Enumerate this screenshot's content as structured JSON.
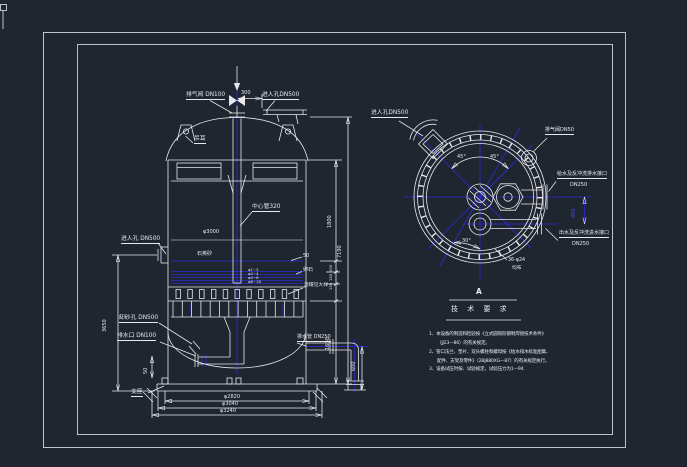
{
  "window": {
    "background": "#20262f"
  },
  "colors": {
    "frame_green": "#00ff00",
    "line_white": "#e8e8ec",
    "centerline_blue": "#2b2bdd"
  },
  "front_view": {
    "labels": {
      "vent_valve": "排气阀 DN100",
      "top_manhole": "进人孔DN500",
      "lifting_lug": "吊耳",
      "center_pipe": "中心管320",
      "shell_diameter": "φ3000",
      "side_manhole": "进人孔 DN500",
      "quartz_sand": "石英砂",
      "pebble": "卵石",
      "filter_cap": "滤帽见大样",
      "lower_manhole": "卸砂孔 DN500",
      "drain": "排水口 DN100",
      "support": "支座",
      "outlet_pipe": "排水管 DN250"
    },
    "layer_marks": [
      "φ1~2",
      "φ2~4",
      "φ4~8",
      "φ8~16"
    ],
    "dims": {
      "top_offset": "300",
      "freeboard": "50",
      "upper_right": "1800",
      "layer_dims": [
        "100",
        "150",
        "150"
      ],
      "lower_right": "1600",
      "overall": "7190",
      "skirt": "600",
      "left_height": "3650",
      "left_small": "50",
      "bottom_d1": "φ2820",
      "bottom_d2": "φ3040",
      "bottom_d3": "φ3240"
    }
  },
  "top_view": {
    "view_label": "A",
    "labels": {
      "manhole": "进人孔DN500",
      "vent": "排气阀DN50",
      "inlet_line1": "给水及反冲洗排水接口",
      "inlet_line2": "DN250",
      "outlet_line1": "出水及反冲洗进水接口",
      "outlet_line2": "DN250",
      "bolt_note1": "36-φ24",
      "bolt_note2": "均布",
      "angle_a": "45°",
      "angle_b": "45°",
      "angle_c": "30°",
      "offset": "450"
    }
  },
  "notes": {
    "title": "技 术 要 求",
    "lines": [
      "1、本设备的制造和检验按《立式圆筒形钢制焊接技术条件》",
      "（JJ23—86）的有关规定。",
      "2、管口法兰、垫片、双头螺柱和螺母按《给水排水标准图集、",
      "配件、支架及零件》（2BJ880XG—87）的有关规定执行。",
      "3、设备试压时按、试验规定，试验压力为1—94."
    ]
  }
}
